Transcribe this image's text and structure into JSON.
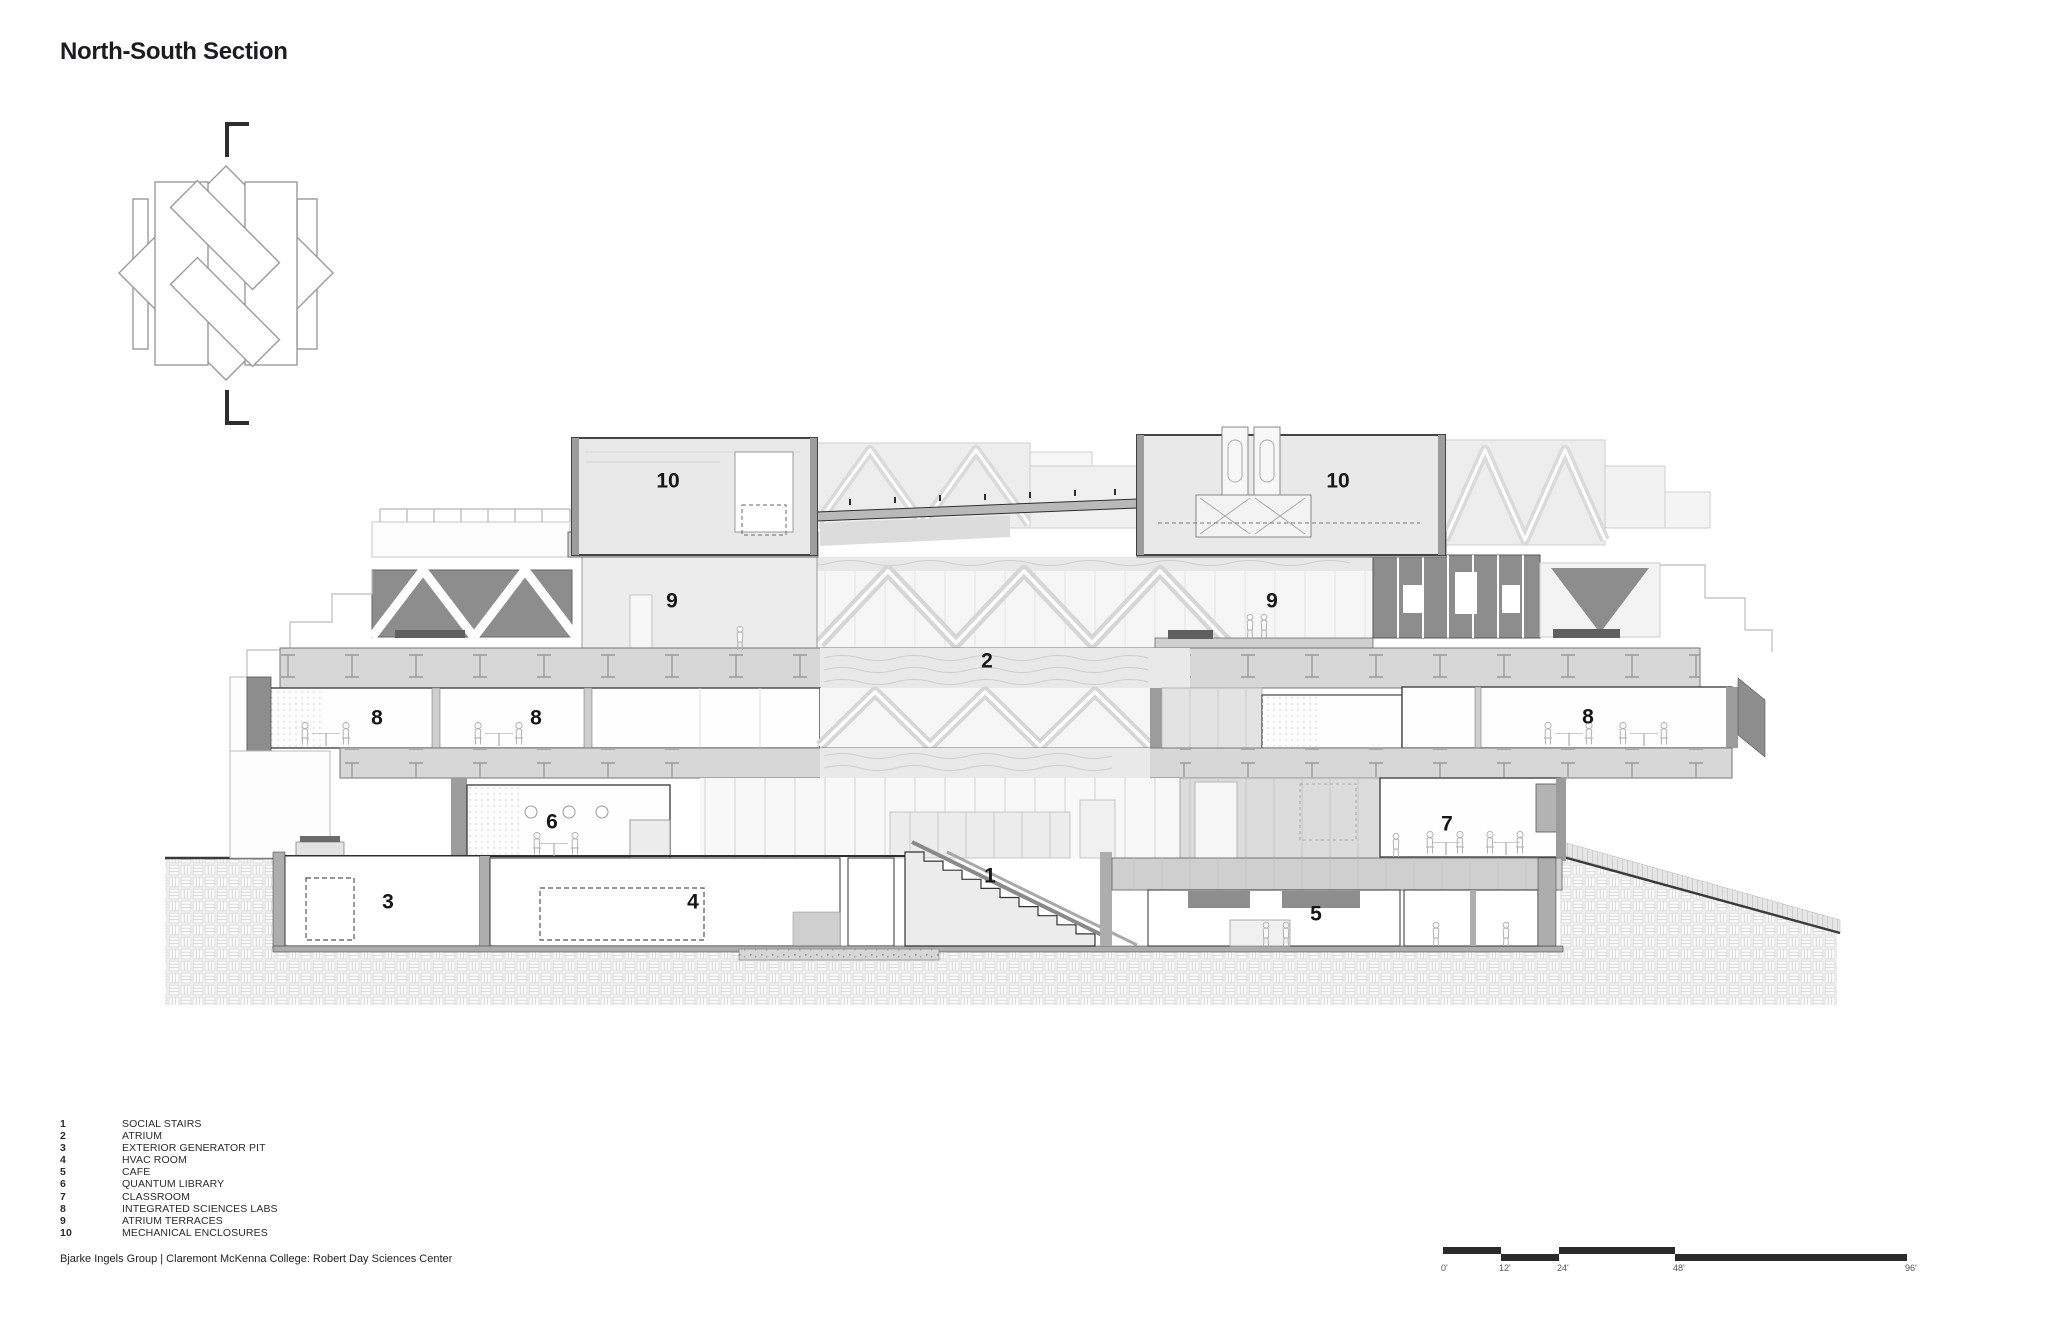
{
  "title": "North-South Section",
  "legend": {
    "items": [
      {
        "num": "1",
        "label": "SOCIAL STAIRS"
      },
      {
        "num": "2",
        "label": "ATRIUM"
      },
      {
        "num": "3",
        "label": "EXTERIOR GENERATOR PIT"
      },
      {
        "num": "4",
        "label": "HVAC ROOM"
      },
      {
        "num": "5",
        "label": "CAFE"
      },
      {
        "num": "6",
        "label": "QUANTUM LIBRARY"
      },
      {
        "num": "7",
        "label": "CLASSROOM"
      },
      {
        "num": "8",
        "label": "INTEGRATED SCIENCES LABS"
      },
      {
        "num": "9",
        "label": "ATRIUM TERRACES"
      },
      {
        "num": "10",
        "label": "MECHANICAL ENCLOSURES"
      }
    ]
  },
  "attribution": "Bjarke Ingels Group | Claremont McKenna College: Robert Day Sciences Center",
  "scale_bar": {
    "feet": [
      0,
      12,
      24,
      48,
      96
    ],
    "labels": [
      "0'",
      "12'",
      "24'",
      "48'",
      "96'"
    ]
  },
  "drawing": {
    "markers": [
      {
        "n": "1",
        "x": 990,
        "y": 877
      },
      {
        "n": "2",
        "x": 987,
        "y": 662
      },
      {
        "n": "3",
        "x": 388,
        "y": 903
      },
      {
        "n": "4",
        "x": 693,
        "y": 903
      },
      {
        "n": "5",
        "x": 1316,
        "y": 915
      },
      {
        "n": "6",
        "x": 552,
        "y": 823
      },
      {
        "n": "7",
        "x": 1447,
        "y": 825
      },
      {
        "n": "8",
        "x": 377,
        "y": 719
      },
      {
        "n": "8",
        "x": 536,
        "y": 719
      },
      {
        "n": "8",
        "x": 1588,
        "y": 718
      },
      {
        "n": "9",
        "x": 672,
        "y": 602
      },
      {
        "n": "9",
        "x": 1272,
        "y": 602
      },
      {
        "n": "10",
        "x": 668,
        "y": 482
      },
      {
        "n": "10",
        "x": 1338,
        "y": 482
      }
    ]
  },
  "colors": {
    "ink": "#1f1f1f",
    "dark_panel": "#8d8d8d",
    "poche": "#adadad",
    "light_fill": "#ededed"
  }
}
